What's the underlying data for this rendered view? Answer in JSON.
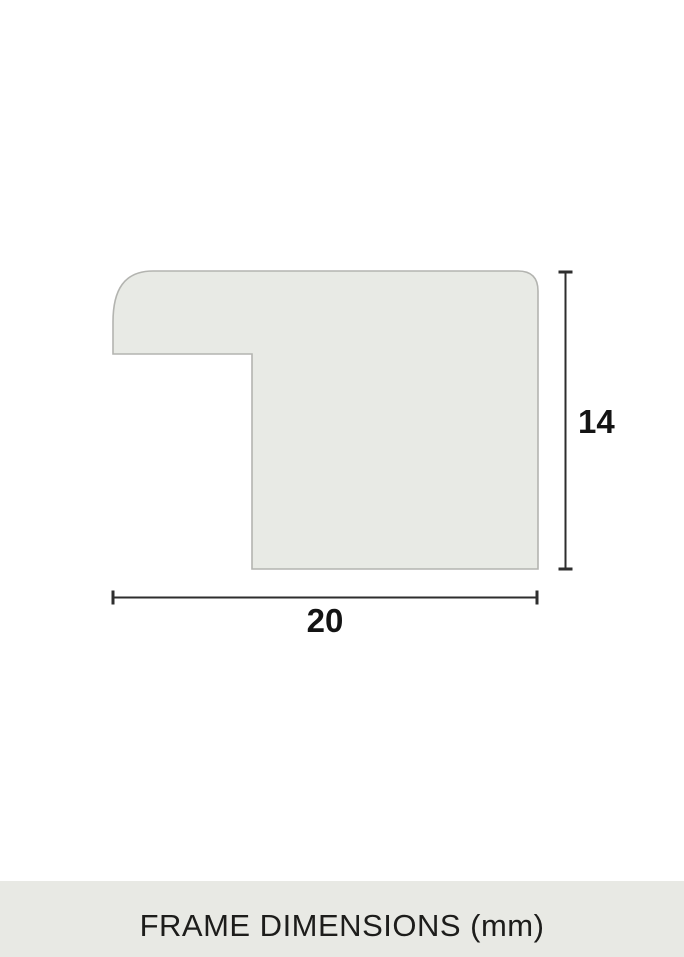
{
  "page": {
    "background_color": "#ffffff"
  },
  "diagram": {
    "type": "frame-profile-cross-section",
    "width_label": "20",
    "height_label": "14",
    "width_mm": 20,
    "height_mm": 14,
    "unit": "mm",
    "fill_color": "#e8eae5",
    "outline_color": "#b3b4b0",
    "dimension_line_color": "#2e2e2e",
    "label_color": "#141414"
  },
  "footer": {
    "label": "FRAME DIMENSIONS (mm)",
    "background": "#e8e9e4",
    "text_color": "#1d1d1b"
  }
}
